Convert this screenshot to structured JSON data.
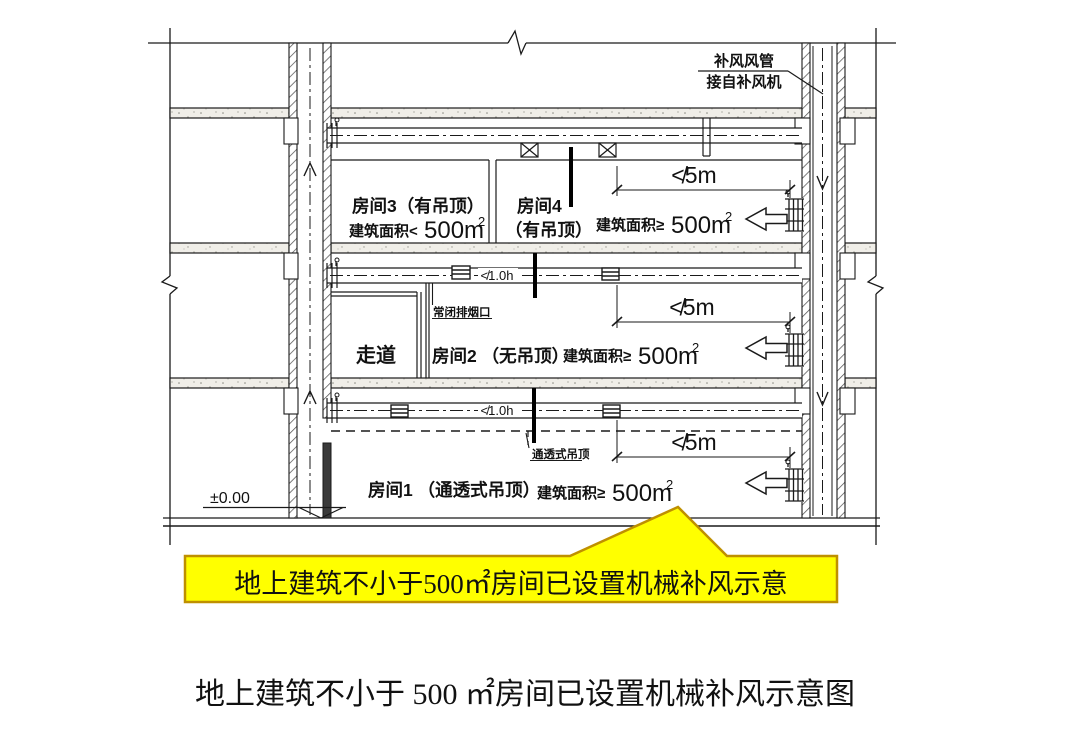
{
  "caption": {
    "text": "地上建筑不小于 500 ㎡房间已设置机械补风示意图"
  },
  "callout": {
    "text": "地上建筑不小于500㎡房间已设置机械补风示意",
    "fill": "#ffff00",
    "border": "#bf9000"
  },
  "supply_note": {
    "line1": "补风风管",
    "line2": "接自补风机"
  },
  "rooms": {
    "room3": {
      "name": "房间3（有吊顶）",
      "area_prefix": "建筑面积<",
      "area_value": "500m",
      "area_sup": "2"
    },
    "room4": {
      "name_line1": "房间4",
      "name_line2": "（有吊顶）",
      "area_prefix": "建筑面积≥",
      "area_value": "500m",
      "area_sup": "2"
    },
    "corridor": {
      "name": "走道"
    },
    "room2": {
      "name": "房间2 （无吊顶）",
      "area_prefix": "建筑面积≥",
      "area_value": "500m",
      "area_sup": "2"
    },
    "room1": {
      "name": "房间1 （通透式吊顶）",
      "area_prefix": "建筑面积≥",
      "area_value": "500m",
      "area_sup": "2"
    }
  },
  "annotations": {
    "smoke_outlet_label": "常闭排烟口",
    "open_ceiling_label": "通透式吊顶",
    "duct_rating_floor2": "≮1.0h",
    "duct_rating_floor1": "≮1.0h",
    "dim_floor3": "≮5m",
    "dim_floor2": "≮5m",
    "dim_floor1": "≮5m",
    "elevation": "±0.00"
  }
}
